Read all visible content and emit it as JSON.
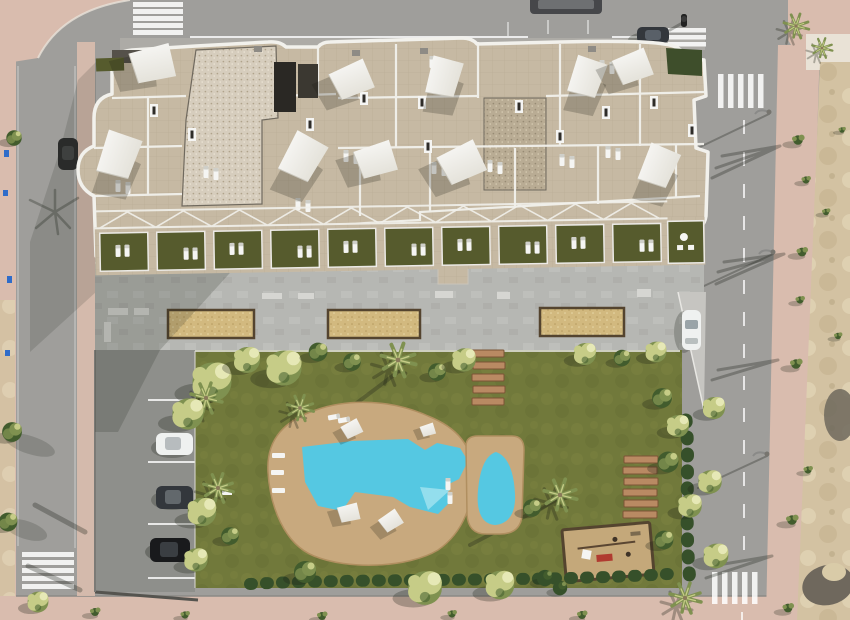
{
  "scene": {
    "title": "Aerial top-down 3D render of a new-build apartment complex with communal pool garden, surrounded by streets and a vacant sandy lot",
    "view": "top-down aerial render, daytime, long shadows cast toward lower-left",
    "elements": [
      "horizontal street along top with van, dark car and motorbike",
      "vertical street on left with pink sidewalks and lower zebra crossing",
      "vertical street on right with dashed center line, street lamps and tree shadows",
      "five zebra crosswalks",
      "apartment building with beige paver roof terraces and white parapets",
      "ten white shade sails on rooftop terraces",
      "rooftop gravel patches, stair boxes, skylights and sun loungers",
      "row of ground-floor terraces with artificial grass and white pergola",
      "concrete plaza with three sand petanque courts and benches",
      "private parking strip with three parked cars and a white car on the side ramp",
      "communal garden lawn with palms, shrubs and hedges",
      "main free-form swimming pool on sandstone deck with parasols and loungers",
      "small teardrop children's pool",
      "two sets of wooden stepping planks",
      "fenced playground with sand surface",
      "vacant sandy lot with scrub and rubble on the right",
      "pink pedestrian sidewalk across the bottom"
    ],
    "counts": {
      "shade_sails": 10,
      "ground_floor_terraces": 11,
      "sand_courts": 3,
      "pools": 2,
      "parked_cars_property": 4,
      "vehicles_on_street": 3,
      "crosswalks": 5,
      "wooden_plank_sets": 2
    }
  },
  "palette": {
    "road": "#9f9e9b",
    "roadDark": "#8f8e8b",
    "sidewalkPink": "#d9bcae",
    "sidewalkTile": "#e9e2d6",
    "dirt": "#d3c2a2",
    "dirtLight": "#e6d8ba",
    "rubble": "#6f685d",
    "paver": "#c6b9a3",
    "paverLine": "#b2a58e",
    "gravel": "#d6cdbd",
    "gravelDark": "#b9ac94",
    "parapet": "#f2f1ec",
    "terraceGreen": "#565b2d",
    "lawn": "#71793b",
    "lawnLight": "#8b9149",
    "lawnDark": "#5a622f",
    "hedge": "#36502a",
    "treeYellow": "#c6cc87",
    "treeLight": "#e6e8b6",
    "treeGreen": "#7f9150",
    "treeDark": "#425c2d",
    "trunk": "#8a7a5a",
    "poolWater": "#55c8e2",
    "poolLight": "#9fe2ef",
    "deck": "#c8a97e",
    "plaza": "#b6b7b3",
    "parking": "#8e8f8b",
    "sandCourt": "#d2b97f",
    "wood": "#54442f",
    "plank": "#b98a63",
    "playSand": "#c4a87a",
    "white": "#f5f5f3",
    "furniture": "#d6d6d2",
    "carWhite": "#eff1f0",
    "carDark": "#33373c",
    "carBlack": "#191a1c",
    "vanGray": "#46474a",
    "blueItem": "#2f6cc9"
  }
}
